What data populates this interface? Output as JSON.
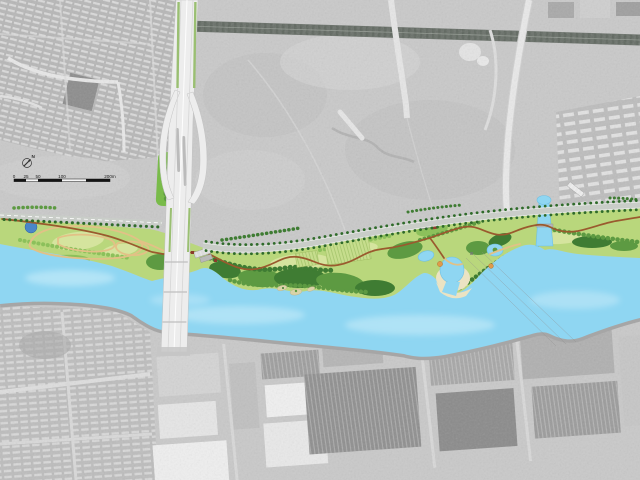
{
  "map": {
    "kind": "riverfront-park-masterplan-over-aerial-photo",
    "scale_bar": {
      "labels": [
        "0",
        "25",
        "50",
        "100",
        "200m"
      ]
    },
    "north_arrow": {
      "label": "N"
    },
    "colors": {
      "river": "#8fd6f2",
      "river_light": "#d6f1fb",
      "pond": "#4a86c8",
      "sand": "#ebe3c3",
      "park_base": "#b9d77c",
      "lawn": "#d5e49e",
      "tree_dark": "#3f7c33",
      "tree_mid": "#5d9a42",
      "tree_light": "#8cc05b",
      "path_primary": "#9a5a2e",
      "path_secondary": "#e2c186",
      "road_new": "#c9cdc8",
      "road_tree": "#2f6b2a",
      "bridge_deck": "#ededed",
      "bridge_verge": "#9abf72",
      "aerial_base": "#c9c9c9",
      "aerial_road_dark": "#6a716a",
      "quay": "#a6a6a6"
    }
  }
}
